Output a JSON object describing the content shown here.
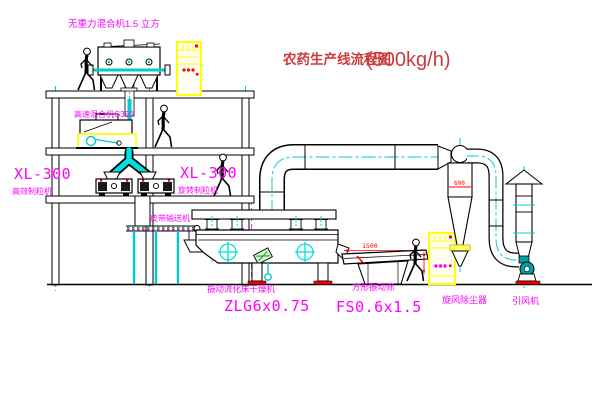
{
  "title": {
    "main": "农药生产线流程图",
    "capacity": "(500kg/h)"
  },
  "labels": {
    "gravity_mixer": "无重力混合机1.5 立方",
    "high_speed_mixer": "高速混合机G350",
    "granulator_left_model": "XL-300",
    "granulator_left_name": "高效制粒机",
    "granulator_right_model": "XL-300",
    "granulator_right_name": "旋转制粒机",
    "belt_conveyor": "皮带输送机",
    "dryer_name": "振动流化床干燥机",
    "dryer_model": "ZLG6x0.75",
    "sieve_name": "方形振动筛",
    "sieve_model": "FS0.6x1.5",
    "cyclone": "旋风除尘器",
    "fan": "引风机"
  },
  "dimensions": {
    "sieve_length": "1500",
    "cyclone_body": "600"
  },
  "colors": {
    "line": "#000000",
    "centerline": "#00cccc",
    "label": "#ff00ff",
    "dimension": "#ff0000",
    "title": "#cc3a3a",
    "cabinet": "#ffff00",
    "conveyor_dots": "#00bb00",
    "fan_body": "#00a3a3",
    "foot_pad": "#ee0000"
  }
}
